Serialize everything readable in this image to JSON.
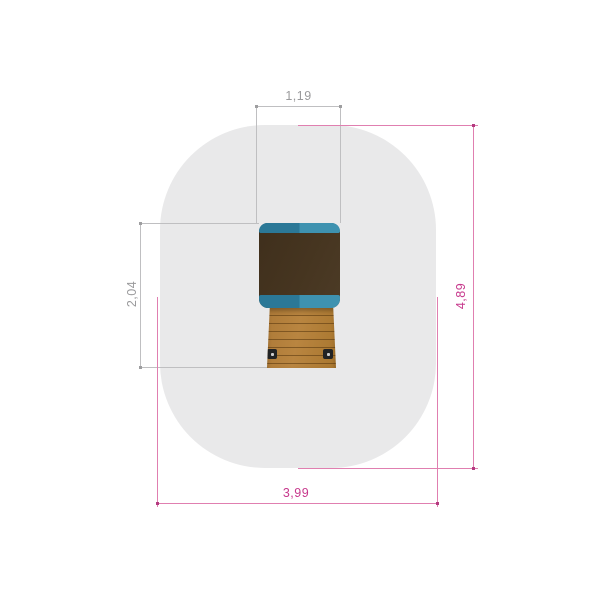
{
  "drawing": {
    "type": "top-view technical drawing of playground equipment",
    "safety_zone_color": "#e9e9ea",
    "equipment": {
      "roof_color": "#463520",
      "roof_trim_left_color": "#2b7897",
      "roof_trim_right_color": "#3e92b0",
      "wood_color": "#b5813f",
      "wood_slat_line_color": "#7c5423",
      "bolt_color": "#222324"
    },
    "dimensions": {
      "top_width": {
        "label": "1,19",
        "color": "#9a9a9c"
      },
      "left_height": {
        "label": "2,04",
        "color": "#9a9a9c"
      },
      "right_height": {
        "label": "4,89",
        "color": "#c7388c"
      },
      "bottom_width": {
        "label": "3,99",
        "color": "#c7388c"
      }
    }
  }
}
